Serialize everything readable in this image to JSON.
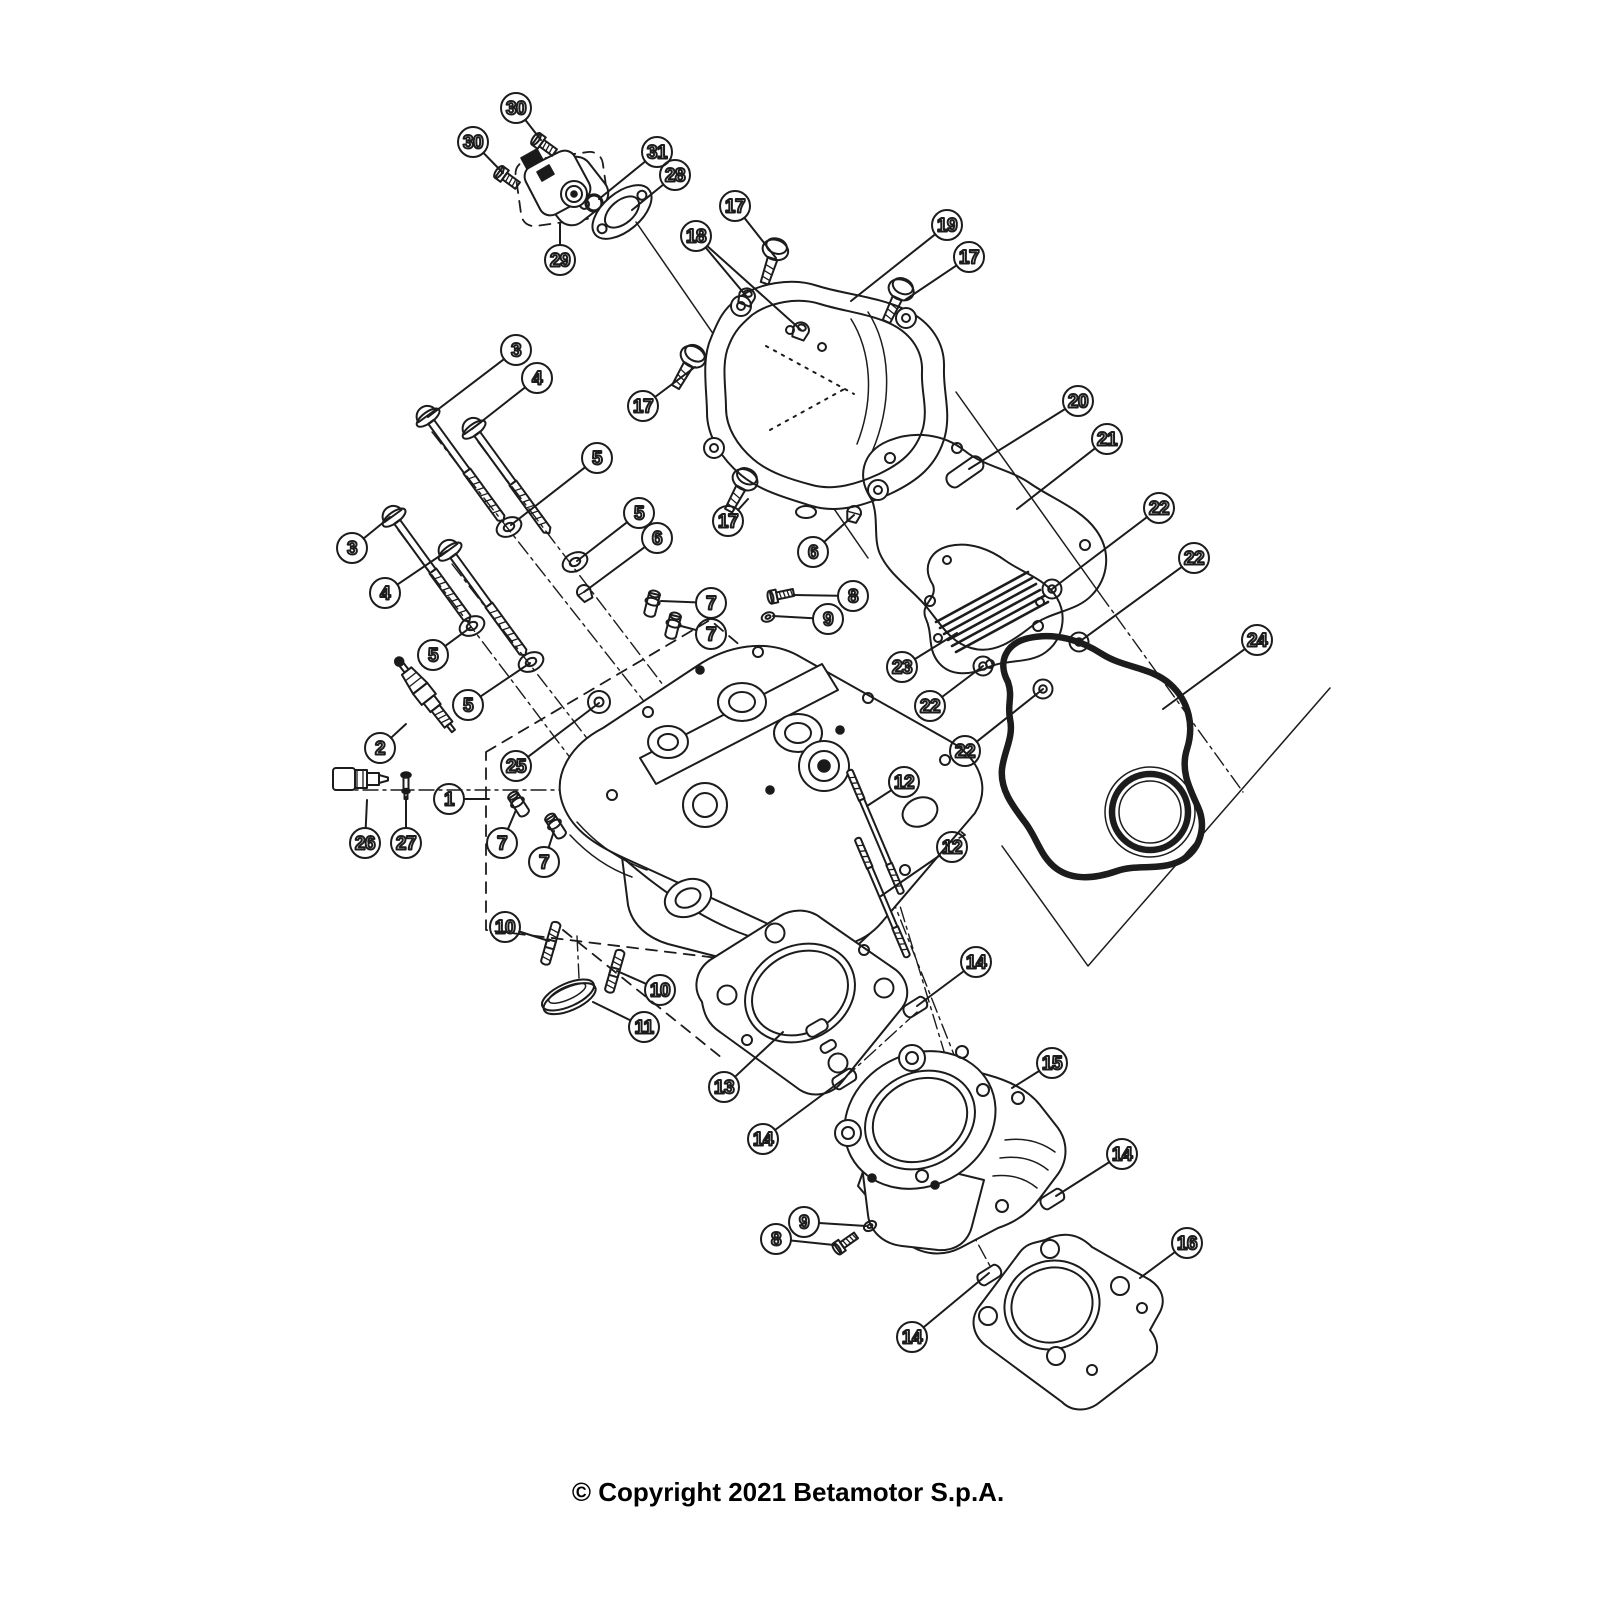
{
  "copyright": "© Copyright 2021 Betamotor S.p.A.",
  "colors": {
    "ink": "#1c1c1c",
    "background": "#ffffff"
  },
  "balloons": {
    "radius": 15,
    "font_size": 19
  },
  "callouts": [
    {
      "n": "30",
      "x": 516,
      "y": 108,
      "t": [
        [
          541,
          140
        ]
      ]
    },
    {
      "n": "30",
      "x": 473,
      "y": 142,
      "t": [
        [
          503,
          173
        ]
      ]
    },
    {
      "n": "31",
      "x": 657,
      "y": 152,
      "t": [
        [
          599,
          199
        ]
      ]
    },
    {
      "n": "28",
      "x": 675,
      "y": 175,
      "t": [
        [
          632,
          210
        ]
      ]
    },
    {
      "n": "29",
      "x": 560,
      "y": 260,
      "t": [
        [
          560,
          224
        ]
      ]
    },
    {
      "n": "17",
      "x": 735,
      "y": 206,
      "t": [
        [
          776,
          258
        ]
      ]
    },
    {
      "n": "19",
      "x": 947,
      "y": 225,
      "t": [
        [
          851,
          301
        ]
      ]
    },
    {
      "n": "17",
      "x": 969,
      "y": 257,
      "t": [
        [
          905,
          300
        ]
      ]
    },
    {
      "n": "18",
      "x": 696,
      "y": 236,
      "t": [
        [
          747,
          297
        ],
        [
          801,
          330
        ]
      ]
    },
    {
      "n": "3",
      "x": 516,
      "y": 350,
      "t": [
        [
          428,
          417
        ]
      ]
    },
    {
      "n": "4",
      "x": 537,
      "y": 378,
      "t": [
        [
          472,
          429
        ]
      ]
    },
    {
      "n": "17",
      "x": 643,
      "y": 406,
      "t": [
        [
          695,
          367
        ]
      ]
    },
    {
      "n": "20",
      "x": 1078,
      "y": 401,
      "t": [
        [
          969,
          469
        ]
      ]
    },
    {
      "n": "21",
      "x": 1107,
      "y": 439,
      "t": [
        [
          1017,
          509
        ]
      ]
    },
    {
      "n": "5",
      "x": 597,
      "y": 458,
      "t": [
        [
          511,
          525
        ]
      ]
    },
    {
      "n": "5",
      "x": 639,
      "y": 513,
      "t": [
        [
          577,
          561
        ]
      ]
    },
    {
      "n": "6",
      "x": 657,
      "y": 538,
      "t": [
        [
          584,
          592
        ]
      ]
    },
    {
      "n": "17",
      "x": 728,
      "y": 521,
      "t": [
        [
          748,
          499
        ]
      ]
    },
    {
      "n": "6",
      "x": 813,
      "y": 552,
      "t": [
        [
          854,
          515
        ]
      ]
    },
    {
      "n": "22",
      "x": 1159,
      "y": 508,
      "t": [
        [
          1052,
          589
        ]
      ]
    },
    {
      "n": "22",
      "x": 1194,
      "y": 558,
      "t": [
        [
          1079,
          642
        ]
      ]
    },
    {
      "n": "3",
      "x": 352,
      "y": 548,
      "t": [
        [
          390,
          517
        ]
      ]
    },
    {
      "n": "4",
      "x": 385,
      "y": 593,
      "t": [
        [
          447,
          551
        ]
      ]
    },
    {
      "n": "8",
      "x": 853,
      "y": 596,
      "t": [
        [
          794,
          595
        ]
      ]
    },
    {
      "n": "9",
      "x": 828,
      "y": 619,
      "t": [
        [
          773,
          616
        ]
      ]
    },
    {
      "n": "5",
      "x": 433,
      "y": 655,
      "t": [
        [
          471,
          627
        ]
      ]
    },
    {
      "n": "5",
      "x": 468,
      "y": 705,
      "t": [
        [
          530,
          663
        ]
      ]
    },
    {
      "n": "24",
      "x": 1257,
      "y": 640,
      "t": [
        [
          1163,
          709
        ]
      ]
    },
    {
      "n": "23",
      "x": 902,
      "y": 667,
      "t": [
        [
          957,
          633
        ]
      ]
    },
    {
      "n": "22",
      "x": 930,
      "y": 706,
      "t": [
        [
          983,
          666
        ]
      ]
    },
    {
      "n": "22",
      "x": 965,
      "y": 751,
      "t": [
        [
          1043,
          689
        ]
      ]
    },
    {
      "n": "2",
      "x": 380,
      "y": 748,
      "t": [
        [
          406,
          724
        ]
      ]
    },
    {
      "n": "25",
      "x": 516,
      "y": 766,
      "t": [
        [
          599,
          703
        ]
      ]
    },
    {
      "n": "12",
      "x": 904,
      "y": 782,
      "t": [
        [
          867,
          806
        ]
      ]
    },
    {
      "n": "1",
      "x": 449,
      "y": 799,
      "t": [
        [
          489,
          799
        ]
      ]
    },
    {
      "n": "26",
      "x": 365,
      "y": 843,
      "t": [
        [
          367,
          800
        ]
      ]
    },
    {
      "n": "27",
      "x": 406,
      "y": 843,
      "t": [
        [
          406,
          797
        ]
      ]
    },
    {
      "n": "7",
      "x": 711,
      "y": 603,
      "t": [
        [
          661,
          601
        ]
      ]
    },
    {
      "n": "7",
      "x": 711,
      "y": 634,
      "t": [
        [
          681,
          626
        ]
      ]
    },
    {
      "n": "7",
      "x": 502,
      "y": 843,
      "t": [
        [
          516,
          810
        ]
      ]
    },
    {
      "n": "7",
      "x": 544,
      "y": 862,
      "t": [
        [
          554,
          831
        ]
      ]
    },
    {
      "n": "12",
      "x": 952,
      "y": 847,
      "t": [
        [
          881,
          896
        ]
      ]
    },
    {
      "n": "10",
      "x": 505,
      "y": 927,
      "t": [
        [
          549,
          941
        ]
      ]
    },
    {
      "n": "14",
      "x": 976,
      "y": 962,
      "t": [
        [
          917,
          1006
        ]
      ]
    },
    {
      "n": "10",
      "x": 660,
      "y": 990,
      "t": [
        [
          617,
          971
        ]
      ]
    },
    {
      "n": "11",
      "x": 644,
      "y": 1027,
      "t": [
        [
          593,
          1002
        ]
      ]
    },
    {
      "n": "15",
      "x": 1052,
      "y": 1063,
      "t": [
        [
          1012,
          1088
        ]
      ]
    },
    {
      "n": "13",
      "x": 724,
      "y": 1087,
      "t": [
        [
          783,
          1032
        ]
      ]
    },
    {
      "n": "14",
      "x": 763,
      "y": 1139,
      "t": [
        [
          845,
          1078
        ]
      ]
    },
    {
      "n": "14",
      "x": 1122,
      "y": 1154,
      "t": [
        [
          1056,
          1196
        ]
      ]
    },
    {
      "n": "9",
      "x": 804,
      "y": 1222,
      "t": [
        [
          866,
          1226
        ]
      ]
    },
    {
      "n": "8",
      "x": 776,
      "y": 1239,
      "t": [
        [
          834,
          1245
        ]
      ]
    },
    {
      "n": "16",
      "x": 1187,
      "y": 1243,
      "t": [
        [
          1140,
          1278
        ]
      ]
    },
    {
      "n": "14",
      "x": 912,
      "y": 1337,
      "t": [
        [
          989,
          1273
        ]
      ]
    }
  ]
}
